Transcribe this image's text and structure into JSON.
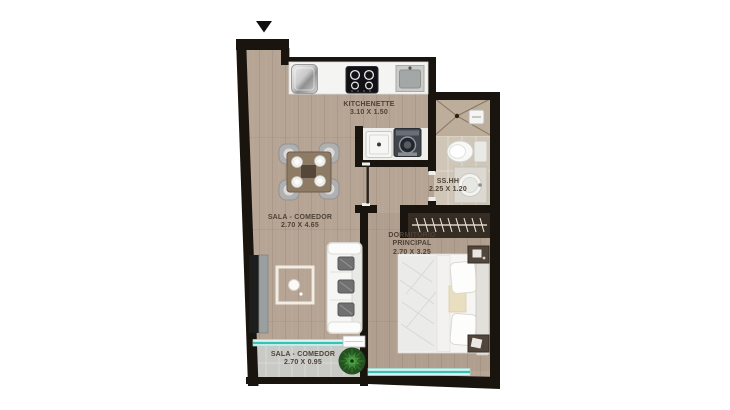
{
  "plan_title": "apartment-floor-plan",
  "rooms": {
    "kitchenette": {
      "name": "KITCHENETTE",
      "dims": "3.10 X 1.50"
    },
    "sala_comedor": {
      "name": "SALA - COMEDOR",
      "dims": "2.70 X 4.65"
    },
    "dormitorio_principal": {
      "line1": "DORMITORIO",
      "line2": "PRINCIPAL",
      "dims": "2.70 X 3.25"
    },
    "bano": {
      "name": "SS.HH",
      "dims": "2.25 X 1.20"
    },
    "balcon": {
      "name": "SALA - COMEDOR",
      "dims": "2.70 X 0.95"
    }
  },
  "markers": {
    "entry_arrow": "triangle-down"
  },
  "furniture": [
    "refrigerator",
    "cooktop",
    "kitchen-sink",
    "washer",
    "dryer",
    "dining-table",
    "dining-chairs",
    "plates",
    "sofa",
    "sofa-pillows",
    "coffee-table-rug",
    "tv-console",
    "bed",
    "pillows",
    "nightstands",
    "closet-hangers",
    "toilet",
    "shower",
    "vanity-sink",
    "balcony-plant",
    "sliding-door",
    "windows"
  ],
  "colors": {
    "wall": "#19140e",
    "wood_floor": "#b6a494",
    "bathroom_floor": "#cfc6b7",
    "shower_floor": "#bdad9b",
    "balcony_floor": "#c9c9c6",
    "glass_teal": "#3dbfb4",
    "plant_green": "#2e6b28",
    "label_text": "#4f4337",
    "background": "#ffffff"
  }
}
